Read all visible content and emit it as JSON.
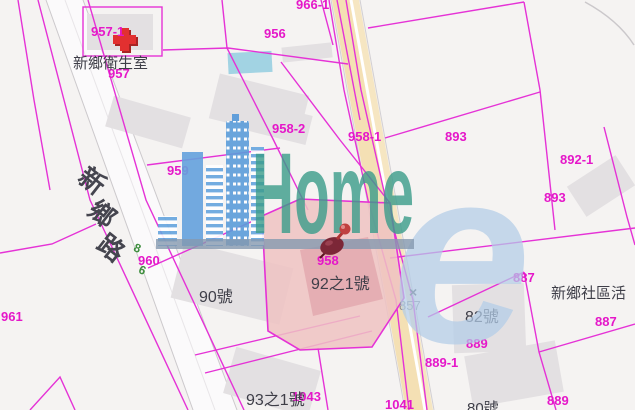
{
  "watermark": {
    "brand": "Home",
    "big_letter": "e"
  },
  "map": {
    "street_chars": [
      "新",
      "鄉",
      "路"
    ],
    "green_chars": [
      "8",
      "6"
    ],
    "survey_marker": {
      "symbol": "×",
      "number": "857"
    },
    "parcel_labels": [
      "957-1",
      "957",
      "956",
      "966-1",
      "958-2",
      "958-1",
      "893",
      "892-1",
      "893",
      "959",
      "960",
      "961",
      "958",
      "887",
      "887",
      "889",
      "889-1",
      "889",
      "1043",
      "1041"
    ],
    "address_labels": [
      "新鄉衛生室",
      "90號",
      "92之1號",
      "82號",
      "新鄉社區活",
      "93之1號",
      "80號"
    ],
    "colors": {
      "parcel_line": "#e517c9",
      "highlight_fill": "#eec2c2",
      "road_fill": "#f4e0b4",
      "watermark_teal": "#3a9c8a",
      "watermark_blue": "#63a3df",
      "health_cross_red": "#e23030"
    }
  }
}
